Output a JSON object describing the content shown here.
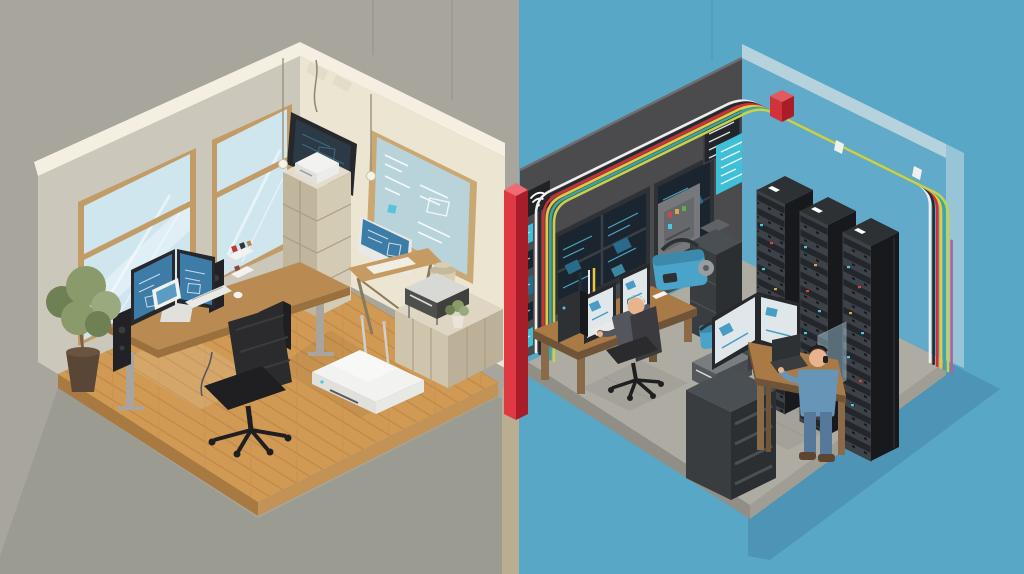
{
  "scene": {
    "title": "home-office-vs-server-room-isometric-illustration",
    "style": "flat isometric vector illustration, split comparison",
    "left_room": {
      "name": "home-office",
      "background": "#a7a59c",
      "objects": [
        "two wood-framed windows with light blue glass",
        "wall-mounted tv with dark blueprint screen",
        "framed blueprint pinboard",
        "two hanging pendant bulbs",
        "small wall shelf with trinkets",
        "tall beige storage cabinet with white router on top",
        "drafting table with imac showing blueprint",
        "low credenza with printer, ceramic jar and small plant",
        "wooden standing desk with dual curved monitors, speakers, keyboard, tablet, pc tower",
        "black ergonomic office chair",
        "potted tree",
        "white wifi router with two antennas on wooden plank floor"
      ]
    },
    "divider": {
      "name": "red-divider-column",
      "color": "#df3a43"
    },
    "right_room": {
      "name": "server-room",
      "background": "#58a7c7",
      "objects": [
        "dark charcoal wall with wifi plaque, cyan monitoring screens, breaker box, list panel, teal info board",
        "colored cable conduits (white, black, red, yellow, teal, magenta) with rounded bends",
        "red cable junction box",
        "vertical multicolor cable drop at right corner",
        "three black server racks with led indicator rows",
        "dark equipment cabinet",
        "seated technician at wooden desk with dual light monitors, pc tower, office chair",
        "blue cable machine",
        "black drawer cabinet with printer and blue device on top",
        "standing technician with headset at wooden standing desk with curved dual monitor and laptop",
        "gray concrete floor with mats"
      ]
    }
  },
  "palette": {
    "bgLeft": "#a7a59c",
    "bgRight": "#58a7c7",
    "shadowLeft": "#9c9b92",
    "shadowRight": "#4d94b6",
    "tanStrip": "#b9ad92",
    "wallLeftFace": "#cbc7ba",
    "wallCream": "#ece5d2",
    "wallTopBand": "#f4efe1",
    "notch": "#e3dcc8",
    "windowFrame": "#c29c66",
    "windowGlass": "#cfe6ee",
    "windowGlass2": "#e2f1f6",
    "whiteStreak": "#ffffff",
    "tvFrame": "#26282b",
    "tvScreen": "#2c3a46",
    "blueprint": "#3e7ca8",
    "blueprintLight": "#5a9cc4",
    "white": "#f2f2f0",
    "whiteDim": "#e0e0dd",
    "boardFrame": "#c9a873",
    "boardFace": "#b9d3da",
    "floorWood": "#d09a55",
    "woodLine": "#b67f42",
    "woodSideL": "#a87a41",
    "woodSideR": "#c29257",
    "deskWood": "#b98a52",
    "deskWoodDark": "#9a703f",
    "deskLeg": "#a9a59e",
    "black": "#222226",
    "chairBlack": "#2b2b2e",
    "chairDark": "#1f1f22",
    "chairMid": "#3a3a3f",
    "keyboard": "#e9e9e6",
    "plantGreen": "#8a9a6b",
    "plantGreenDark": "#6f8055",
    "plantGreenLight": "#9aa97e",
    "potBrown": "#5a4636",
    "potRim": "#6b543f",
    "cabinetL": "#c0b59d",
    "cabinetR": "#d4cbb5",
    "cabinetTop": "#e5ddcb",
    "cabinetSeam": "#a89d86",
    "credenzaL": "#cfc5ac",
    "credenzaR": "#bcb198",
    "credenzaTop": "#ded6c2",
    "printerDark": "#4e4e4c",
    "printerDarker": "#3f3f3d",
    "printerTop": "#d8d8d5",
    "jar": "#d9cdb4",
    "jarDark": "#c4b89e",
    "dividerRed": "#df3a43",
    "dividerRedDark": "#a81d27",
    "dividerRedTop": "#ef6a72",
    "wallDark": "#4b4b4d",
    "wallDarkEdge": "#6e6e70",
    "wallBlueFace": "#61aac9",
    "wallBlueTop": "#b5d2dd",
    "wallBlueEdge": "#97c5d7",
    "floorConcrete": "#adaba2",
    "floorConcreteL": "#918e85",
    "floorConcreteR": "#a09d94",
    "floorMat": "#a29f95",
    "matLine": "#8a877e",
    "rackFront": "#23262a",
    "rackSide": "#17191c",
    "rackTop": "#2e3134",
    "rackStripe": "#3d4248",
    "rackEdge": "#3a3e42",
    "ledCyan": "#4ac8e0",
    "ledRed": "#d5424a",
    "ledAmber": "#d9a64a",
    "screenDark": "#1b2530",
    "screenFrame": "#2e3236",
    "screenDivider": "#3a3f45",
    "cyan": "#54c8e8",
    "cyanDim": "#2a6b8a",
    "panelTeal": "#3fc0d8",
    "grayBox": "#77787b",
    "grayBoxDoor": "#67686b",
    "cableWhite": "#eeeeee",
    "cableYellow": "#e8c93e",
    "cableRed": "#d02f38",
    "cableBlack": "#26282a",
    "cableTeal": "#3aa6a0",
    "cableGreen": "#c6d14e",
    "cableMagenta": "#b0609e",
    "junctionRed": "#d0333c",
    "junctionRedTop": "#e05a60",
    "deskWood2": "#8a6a48",
    "deskWood2Dark": "#6f5437",
    "deskWood2Top": "#a97a45",
    "skin": "#e8b48e",
    "hairDark": "#26221f",
    "hairBrown": "#4a3526",
    "shirtGray": "#53565c",
    "shirtBlue": "#6695b8",
    "jeans": "#56789a",
    "shoeBrown": "#5d4630",
    "machineBlue": "#4aa3c8",
    "machineBlueDark": "#3d89ab",
    "cab2Front": "#3a3d40",
    "cab2Side": "#2c2f32",
    "cab2Seam": "#4a4f54",
    "monitorWhite": "#dfe7ea",
    "widgetBlue": "#4a9cc4",
    "glassPane": "#a8d4e6",
    "metalGray": "#9a9da0"
  }
}
